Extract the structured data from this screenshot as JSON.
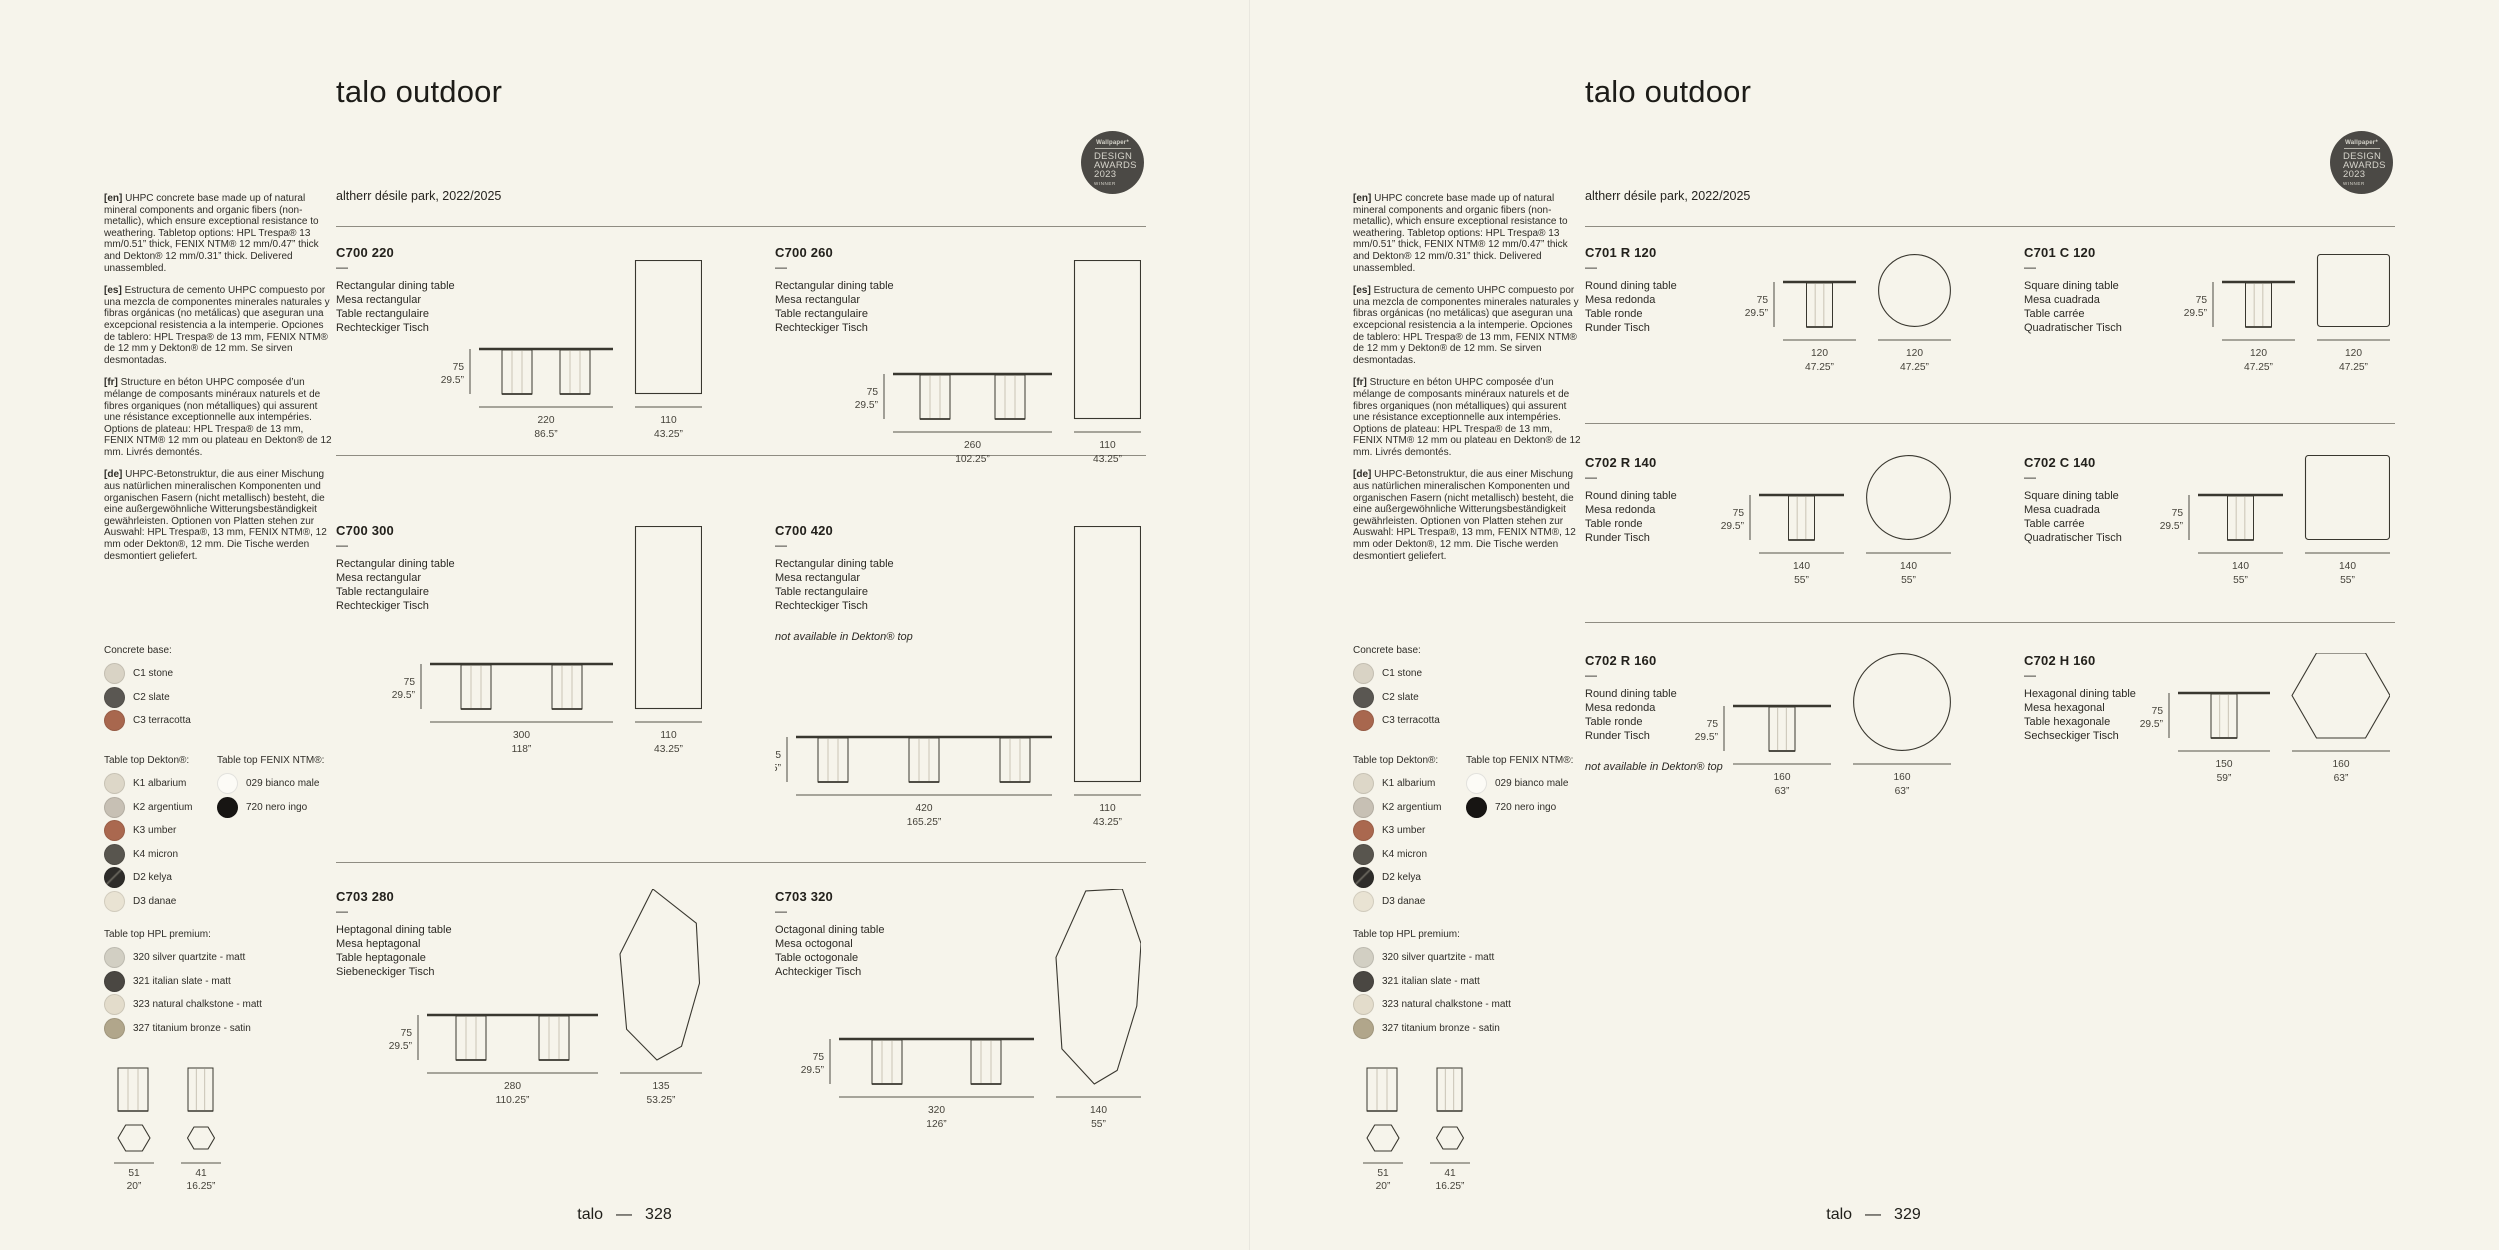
{
  "colors": {
    "background": "#f6f4eb",
    "ink": "#39372f",
    "dim_line": "#55534a",
    "dim_text": "#45423a",
    "rule": "#8f8c82",
    "badge_bg": "#4b4945"
  },
  "badge": {
    "brand": "Wallpaper*",
    "lines": [
      "DESIGN",
      "AWARDS",
      "2023"
    ],
    "winner": "WINNER"
  },
  "shared": {
    "title": "talo outdoor",
    "subtitle": "altherr désile park, 2022/2025",
    "code_dash": "—",
    "intro": [
      {
        "tag": "[en]",
        "text": "UHPC concrete base made up of natural mineral components and organic fibers (non-metallic), which ensure exceptional resistance to weathering. Tabletop options: HPL Trespa® 13 mm/0.51” thick, FENIX NTM® 12 mm/0.47” thick and Dekton® 12 mm/0.31” thick. Delivered unassembled."
      },
      {
        "tag": "[es]",
        "text": "Estructura de cemento UHPC compuesto por una mezcla de componentes minerales naturales y fibras orgánicas (no metálicas) que aseguran una excepcional resistencia a la intemperie. Opciones de tablero: HPL Trespa® de 13 mm, FENIX NTM® de 12 mm y Dekton® de 12 mm. Se sirven desmontadas."
      },
      {
        "tag": "[fr]",
        "text": "Structure en béton UHPC composée d’un mélange de composants minéraux naturels et de fibres organiques (non métalliques) qui assurent une résistance exceptionnelle aux intempéries. Options de plateau: HPL Trespa® de 13 mm, FENIX NTM® 12 mm ou plateau en Dekton® de 12 mm. Livrés demontés."
      },
      {
        "tag": "[de]",
        "text": "UHPC-Betonstruktur, die aus einer Mischung aus natürlichen mineralischen Komponenten und organischen Fasern (nicht metallisch) besteht, die eine außergewöhnliche Witterungsbeständigkeit gewährleisten. Optionen von Platten stehen zur Auswahl: HPL Trespa®, 13 mm, FENIX NTM®, 12 mm oder Dekton®, 12 mm. Die Tische werden desmontiert geliefert."
      }
    ],
    "swatches": {
      "concrete": {
        "label": "Concrete base:",
        "items": [
          {
            "label": "C1 stone",
            "color": "#d9d3c5"
          },
          {
            "label": "C2 slate",
            "color": "#5a5752"
          },
          {
            "label": "C3 terracotta",
            "color": "#a8674e"
          }
        ]
      },
      "dekton": {
        "label": "Table top Dekton®:",
        "items": [
          {
            "label": "K1 albarium",
            "color": "#ddd7c8"
          },
          {
            "label": "K2 argentium",
            "color": "#c7c0b4"
          },
          {
            "label": "K3 umber",
            "color": "#aa684f"
          },
          {
            "label": "K4 micron",
            "color": "#58554e"
          },
          {
            "label": "D2 kelya",
            "color": "#2e2c29",
            "stripe": true
          },
          {
            "label": "D3 danae",
            "color": "#e9e3d3"
          }
        ]
      },
      "fenix": {
        "label": "Table top FENIX NTM®:",
        "items": [
          {
            "label": "029 bianco male",
            "color": "#fcfbf6"
          },
          {
            "label": "720 nero ingo",
            "color": "#171513"
          }
        ]
      },
      "hpl": {
        "label": "Table top HPL premium:",
        "items": [
          {
            "label": "320 silver quartzite - matt",
            "color": "#d2cfc3"
          },
          {
            "label": "321 italian slate - matt",
            "color": "#4a4742"
          },
          {
            "label": "323 natural chalkstone - matt",
            "color": "#e3dccb"
          },
          {
            "label": "327 titanium bronze - satin",
            "color": "#b1a68b"
          }
        ]
      }
    },
    "base_dims": [
      {
        "cm": "51",
        "in": "20”"
      },
      {
        "cm": "41",
        "in": "16.25”"
      }
    ]
  },
  "pages": [
    {
      "footer": {
        "brand": "talo",
        "separator": "—",
        "page": "328"
      },
      "products": [
        {
          "code": "C700 220",
          "names": [
            "Rectangular dining table",
            "Mesa rectangular",
            "Table rectangulaire",
            "Rechteckiger Tisch"
          ],
          "note": "",
          "legs": 2,
          "len_cm": 220,
          "height": {
            "cm": "75",
            "in": "29.5”"
          },
          "length": {
            "cm": "220",
            "in": "86.5”"
          },
          "top": {
            "shape": "rect",
            "w": 110,
            "l": 220,
            "cm": "110",
            "in": "43.25”"
          }
        },
        {
          "code": "C700 260",
          "names": [
            "Rectangular dining table",
            "Mesa rectangular",
            "Table rectangulaire",
            "Rechteckiger Tisch"
          ],
          "note": "",
          "legs": 2,
          "len_cm": 260,
          "height": {
            "cm": "75",
            "in": "29.5”"
          },
          "length": {
            "cm": "260",
            "in": "102.25”"
          },
          "top": {
            "shape": "rect",
            "w": 110,
            "l": 260,
            "cm": "110",
            "in": "43.25”"
          }
        },
        {
          "code": "C700 300",
          "names": [
            "Rectangular dining table",
            "Mesa rectangular",
            "Table rectangulaire",
            "Rechteckiger Tisch"
          ],
          "note": "",
          "legs": 2,
          "len_cm": 300,
          "height": {
            "cm": "75",
            "in": "29.5”"
          },
          "length": {
            "cm": "300",
            "in": "118”"
          },
          "top": {
            "shape": "rect",
            "w": 110,
            "l": 300,
            "cm": "110",
            "in": "43.25”"
          }
        },
        {
          "code": "C700 420",
          "names": [
            "Rectangular dining table",
            "Mesa rectangular",
            "Table rectangulaire",
            "Rechteckiger Tisch"
          ],
          "note": "not available in Dekton® top",
          "legs": 3,
          "len_cm": 420,
          "height": {
            "cm": "75",
            "in": "29.5”"
          },
          "length": {
            "cm": "420",
            "in": "165.25”"
          },
          "top": {
            "shape": "rect",
            "w": 110,
            "l": 420,
            "cm": "110",
            "in": "43.25”"
          }
        },
        {
          "code": "C703 280",
          "names": [
            "Heptagonal dining table",
            "Mesa heptagonal",
            "Table heptagonale",
            "Siebeneckiger Tisch"
          ],
          "note": "",
          "legs": 2,
          "len_cm": 280,
          "height": {
            "cm": "75",
            "in": "29.5”"
          },
          "length": {
            "cm": "280",
            "in": "110.25”"
          },
          "top": {
            "shape": "heptagon",
            "w": 135,
            "l": 280,
            "cm": "135",
            "in": "53.25”"
          }
        },
        {
          "code": "C703 320",
          "names": [
            "Octagonal dining table",
            "Mesa octogonal",
            "Table octogonale",
            "Achteckiger Tisch"
          ],
          "note": "",
          "legs": 2,
          "len_cm": 320,
          "height": {
            "cm": "75",
            "in": "29.5”"
          },
          "length": {
            "cm": "320",
            "in": "126”"
          },
          "top": {
            "shape": "octagon",
            "w": 140,
            "l": 320,
            "cm": "140",
            "in": "55”"
          }
        }
      ]
    },
    {
      "footer": {
        "brand": "talo",
        "separator": "—",
        "page": "329"
      },
      "products": [
        {
          "code": "C701 R 120",
          "names": [
            "Round dining table",
            "Mesa redonda",
            "Table ronde",
            "Runder Tisch"
          ],
          "note": "",
          "legs": 1,
          "len_cm": 120,
          "height": {
            "cm": "75",
            "in": "29.5”"
          },
          "length": {
            "cm": "120",
            "in": "47.25”"
          },
          "top": {
            "shape": "circle",
            "w": 120,
            "l": 120,
            "cm": "120",
            "in": "47.25”"
          }
        },
        {
          "code": "C701 C 120",
          "names": [
            "Square dining table",
            "Mesa cuadrada",
            "Table carrée",
            "Quadratischer Tisch"
          ],
          "note": "",
          "legs": 1,
          "len_cm": 120,
          "height": {
            "cm": "75",
            "in": "29.5”"
          },
          "length": {
            "cm": "120",
            "in": "47.25”"
          },
          "top": {
            "shape": "square",
            "w": 120,
            "l": 120,
            "cm": "120",
            "in": "47.25”"
          }
        },
        {
          "code": "C702 R 140",
          "names": [
            "Round dining table",
            "Mesa redonda",
            "Table ronde",
            "Runder Tisch"
          ],
          "note": "",
          "legs": 1,
          "len_cm": 140,
          "height": {
            "cm": "75",
            "in": "29.5”"
          },
          "length": {
            "cm": "140",
            "in": "55”"
          },
          "top": {
            "shape": "circle",
            "w": 140,
            "l": 140,
            "cm": "140",
            "in": "55”"
          }
        },
        {
          "code": "C702 C 140",
          "names": [
            "Square dining table",
            "Mesa cuadrada",
            "Table carrée",
            "Quadratischer Tisch"
          ],
          "note": "",
          "legs": 1,
          "len_cm": 140,
          "height": {
            "cm": "75",
            "in": "29.5”"
          },
          "length": {
            "cm": "140",
            "in": "55”"
          },
          "top": {
            "shape": "square",
            "w": 140,
            "l": 140,
            "cm": "140",
            "in": "55”"
          }
        },
        {
          "code": "C702 R 160",
          "names": [
            "Round dining table",
            "Mesa redonda",
            "Table ronde",
            "Runder Tisch"
          ],
          "note": "not available in Dekton® top",
          "legs": 1,
          "len_cm": 160,
          "height": {
            "cm": "75",
            "in": "29.5”"
          },
          "length": {
            "cm": "160",
            "in": "63”"
          },
          "top": {
            "shape": "circle",
            "w": 160,
            "l": 160,
            "cm": "160",
            "in": "63”"
          }
        },
        {
          "code": "C702 H 160",
          "names": [
            "Hexagonal dining table",
            "Mesa hexagonal",
            "Table hexagonale",
            "Sechseckiger Tisch"
          ],
          "note": "",
          "legs": 1,
          "len_cm": 150,
          "height": {
            "cm": "75",
            "in": "29.5”"
          },
          "length": {
            "cm": "150",
            "in": "59”"
          },
          "top": {
            "shape": "hexagon",
            "w": 160,
            "l": 139,
            "cm": "160",
            "in": "63”"
          }
        }
      ]
    }
  ]
}
